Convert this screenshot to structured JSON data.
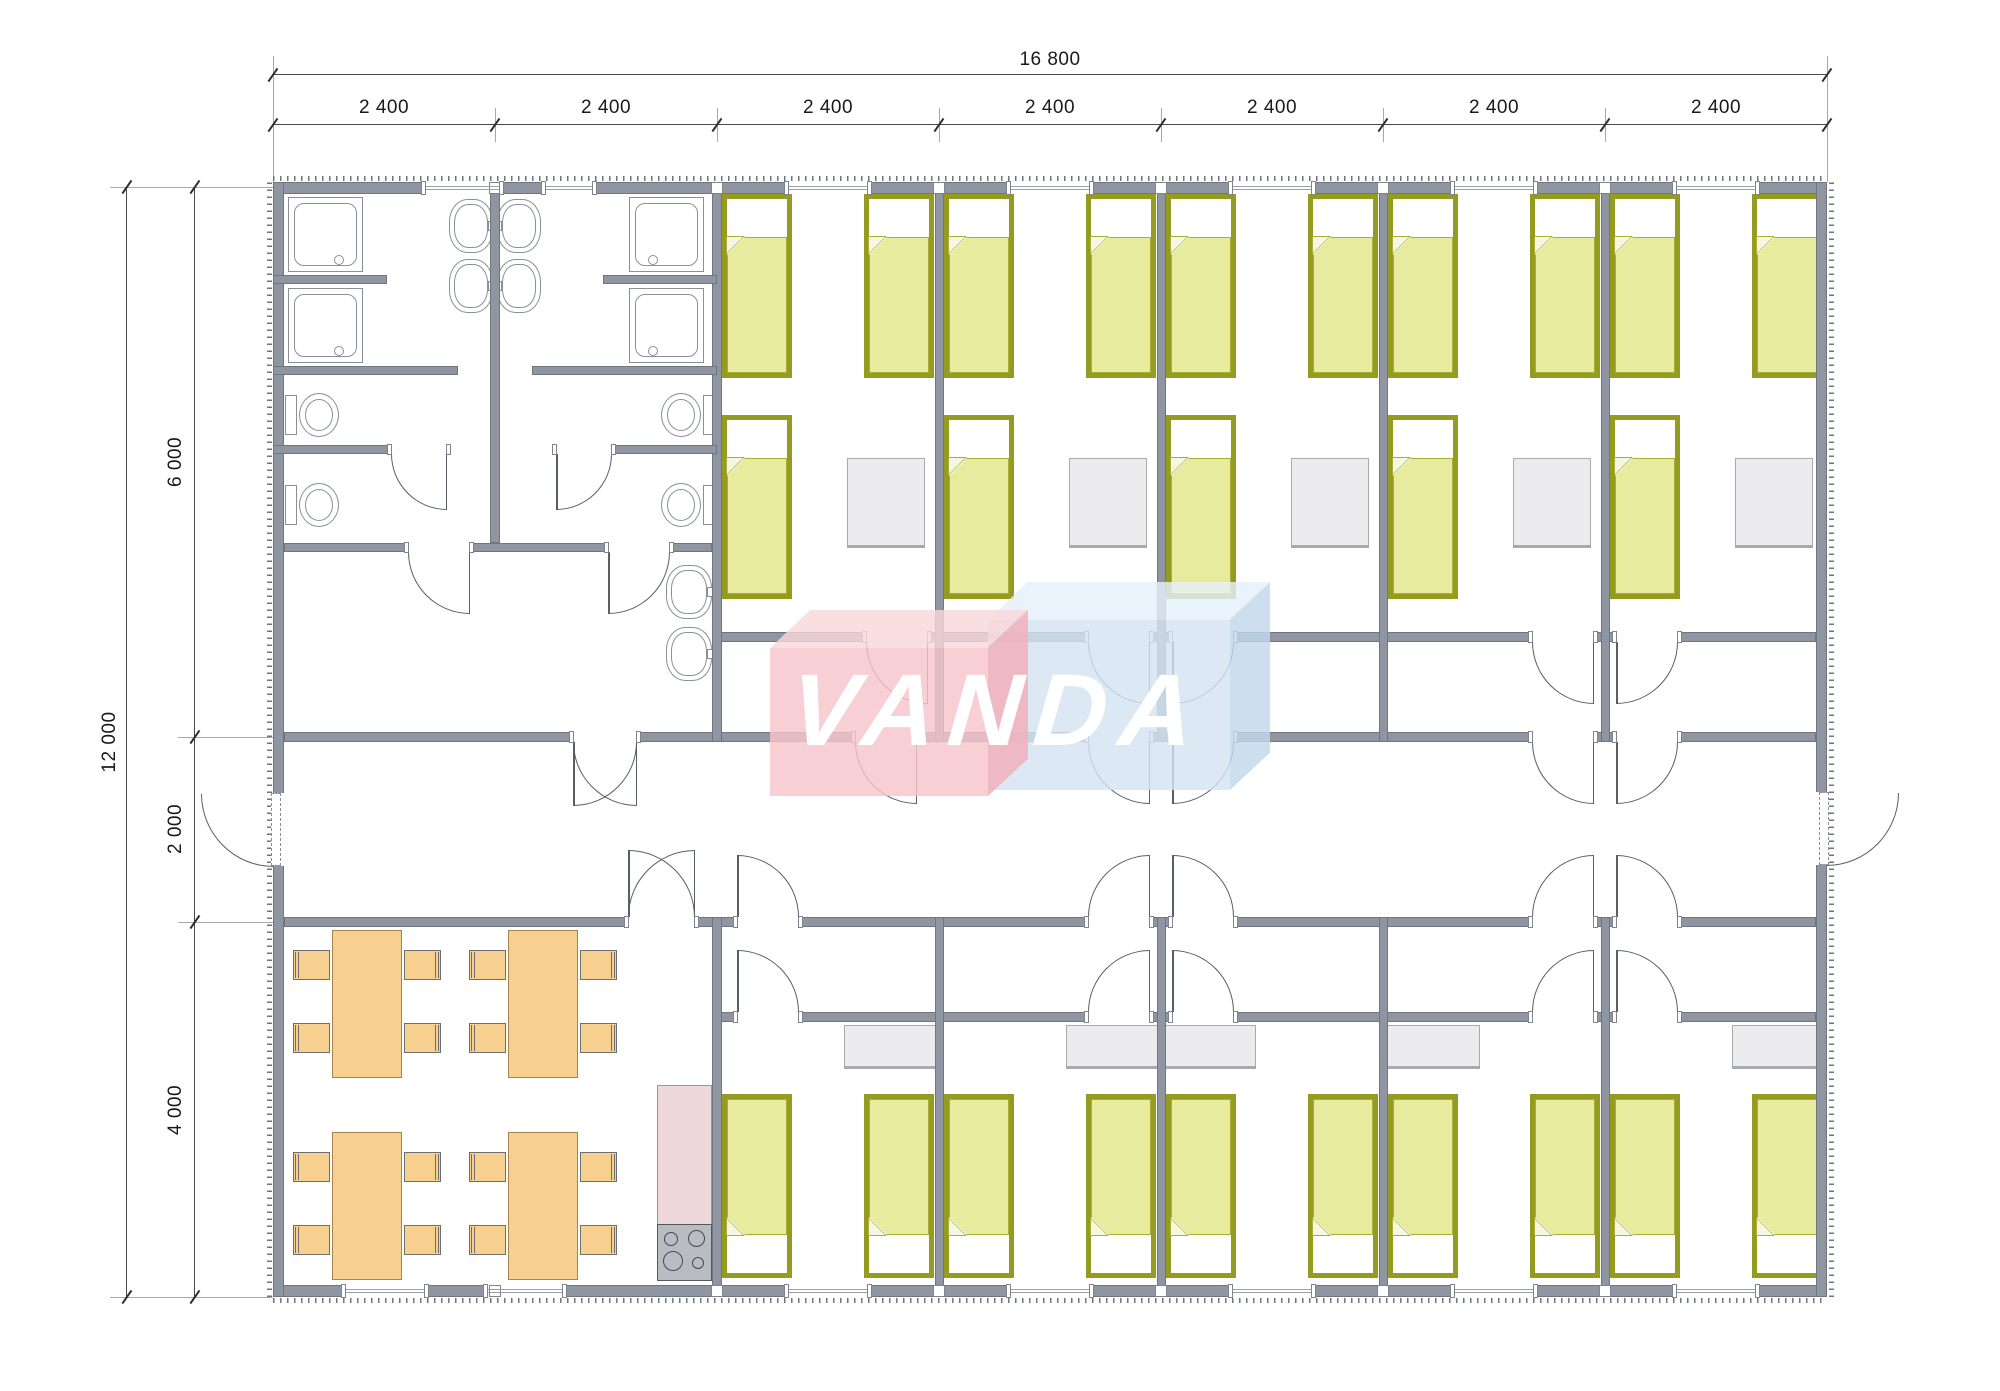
{
  "watermark": {
    "text": "VANDA"
  },
  "dimensions_top": {
    "total": "16 800",
    "modules": [
      "2 400",
      "2 400",
      "2 400",
      "2 400",
      "2 400",
      "2 400",
      "2 400"
    ]
  },
  "dimensions_left": {
    "total": "12 000",
    "sections": [
      "6 000",
      "2 000",
      "4 000"
    ]
  },
  "fixtures": {
    "beds": 25,
    "wardrobes": 10,
    "dining_tables": 4,
    "dining_chairs": 16,
    "showers": 4,
    "toilets": 4,
    "washbasins": 6,
    "kitchen_counter": 1,
    "kitchen_stove": 1,
    "entrance_doors": 2
  },
  "colors": {
    "wall": "#8F96A1",
    "wall_edge": "#70767E",
    "rib": "#6F757B",
    "arc": "#5A5F66",
    "winline": "#9AA0A6",
    "bed_frame": "#959B21",
    "blanket": "#E7EB9D",
    "blanket_edge": "#A9AE35",
    "bed_fold": "#F6F7E2",
    "wood": "#F7CF8E",
    "wood_edge": "#A5854F",
    "chair_edge": "#6E6E6E",
    "cabinet": "#ECECEE",
    "cabinet_edge": "#A7ABB0",
    "counter": "#EFD8DB",
    "stove": "#B9BDC2",
    "fixline": "#8A9097",
    "dimline": "#4A4A4A",
    "dimtext": "#1A1A1A",
    "logo_pink": "#F6C4CB",
    "logo_pink_top": "#F9D8DC",
    "logo_pink_side": "#F2AFBA",
    "logo_blue": "#D4E3F2",
    "logo_blue_top": "#E5F0FA",
    "logo_blue_side": "#C2D7EC",
    "logo_text": "#FFFFFF"
  }
}
